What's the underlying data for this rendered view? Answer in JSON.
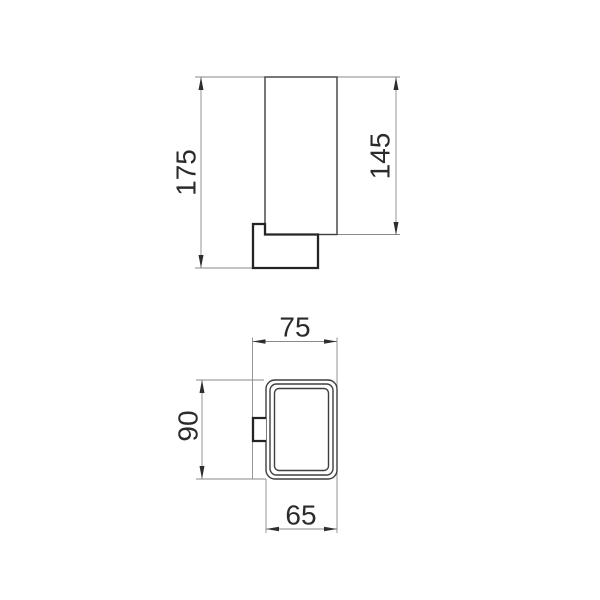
{
  "palette": {
    "background": "#ffffff",
    "main_outline": "#3f3f3f",
    "thick_outline": "#242424",
    "dimension_lines": "#8a8a8a",
    "dimension_text": "#2b2b2b"
  },
  "side_view": {
    "total_height_label": "175",
    "cup_height_label": "145"
  },
  "top_view": {
    "overall_depth_label": "75",
    "overall_height_label": "90",
    "cup_width_label": "65"
  }
}
